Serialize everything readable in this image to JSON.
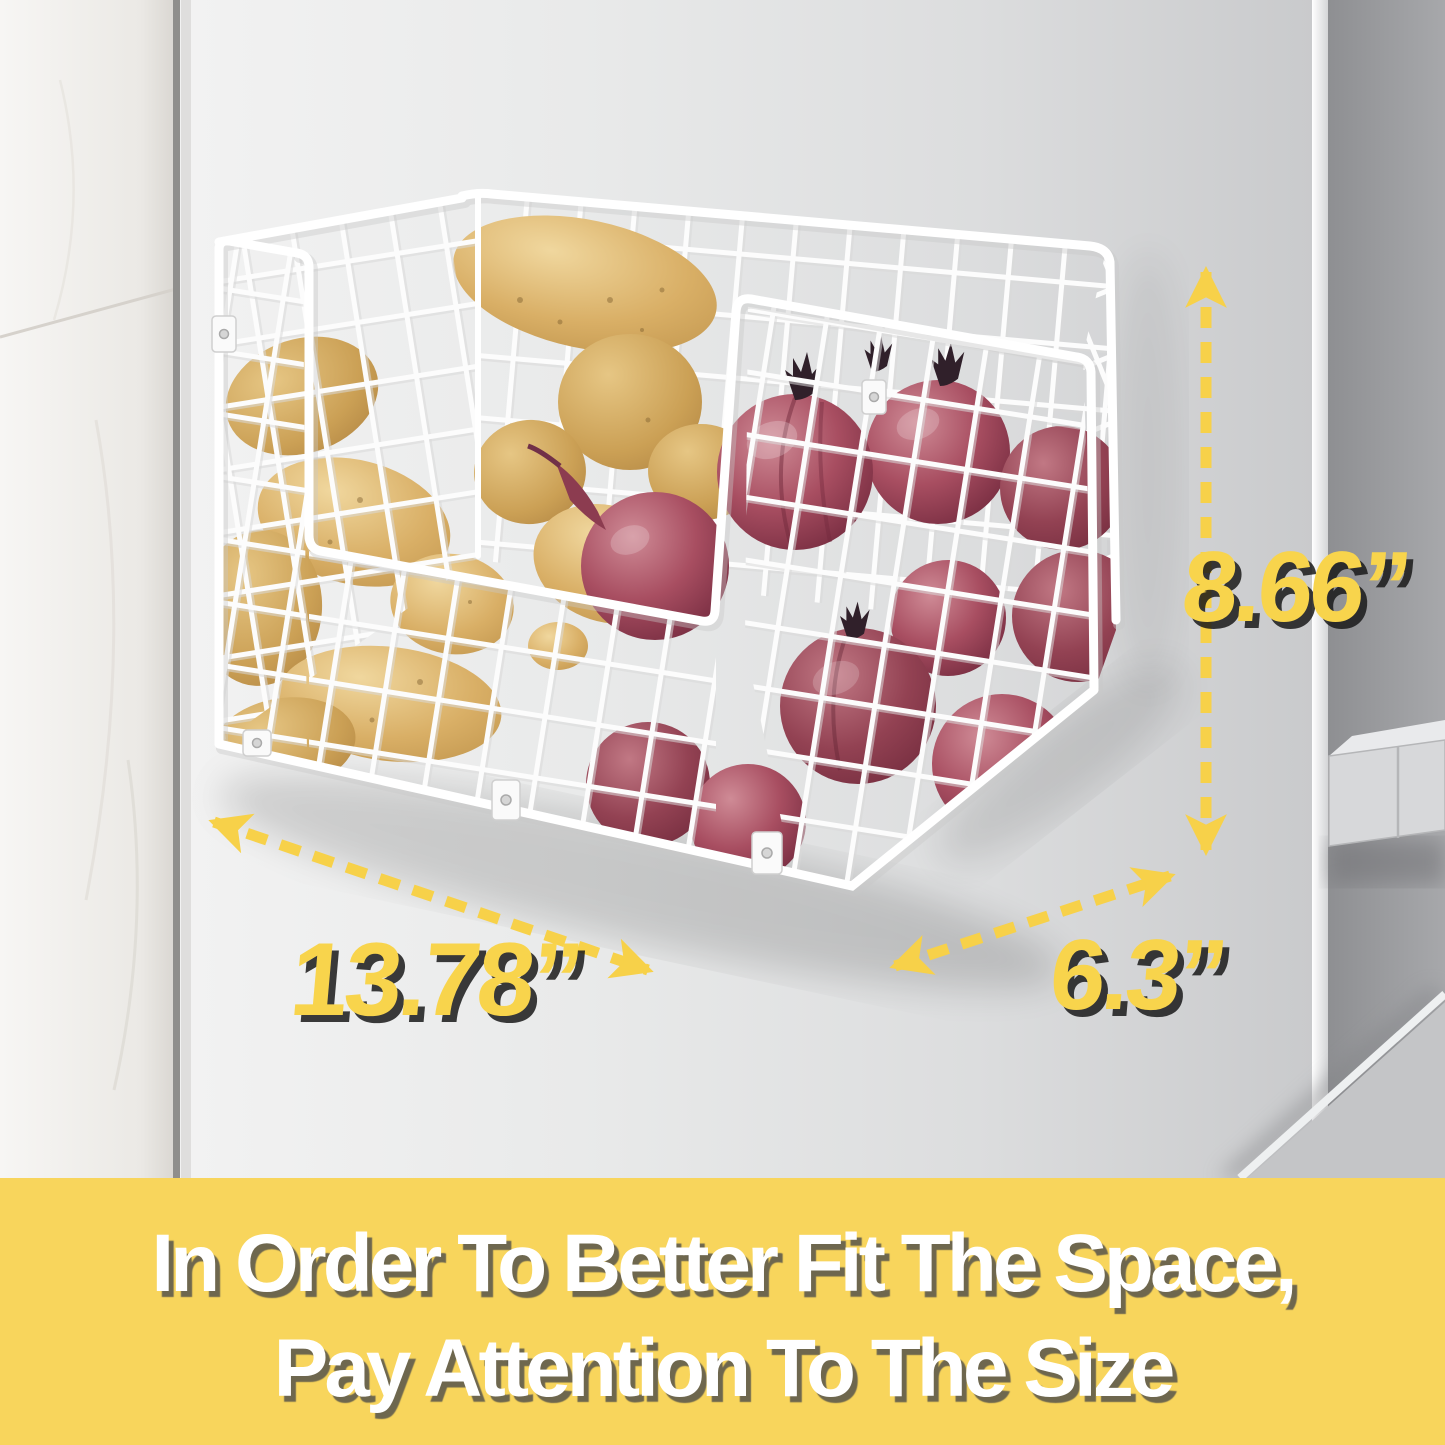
{
  "product_image": {
    "alt": "White wire storage basket mounted on the side of a refrigerator, filled with potatoes and red onions, with size annotations",
    "annotations": {
      "height": "8.66”",
      "width": "13.78”",
      "depth": "6.3”"
    },
    "banner": {
      "line1": "In Order To Better Fit The Space,",
      "line2": "Pay Attention To The Size"
    },
    "colors": {
      "accent_yellow": "#F8D44C",
      "banner_yellow": "#F8D55C",
      "arrow_yellow": "#F7D149",
      "text_white": "#FFFFFF"
    },
    "scene": {
      "wall": "white-marble-tile-wall",
      "surface": "refrigerator-side-panel",
      "door": "refrigerator-door-with-handle",
      "basket": "white-wire-wall-basket",
      "contents": [
        "potatoes",
        "red-onions"
      ]
    }
  }
}
